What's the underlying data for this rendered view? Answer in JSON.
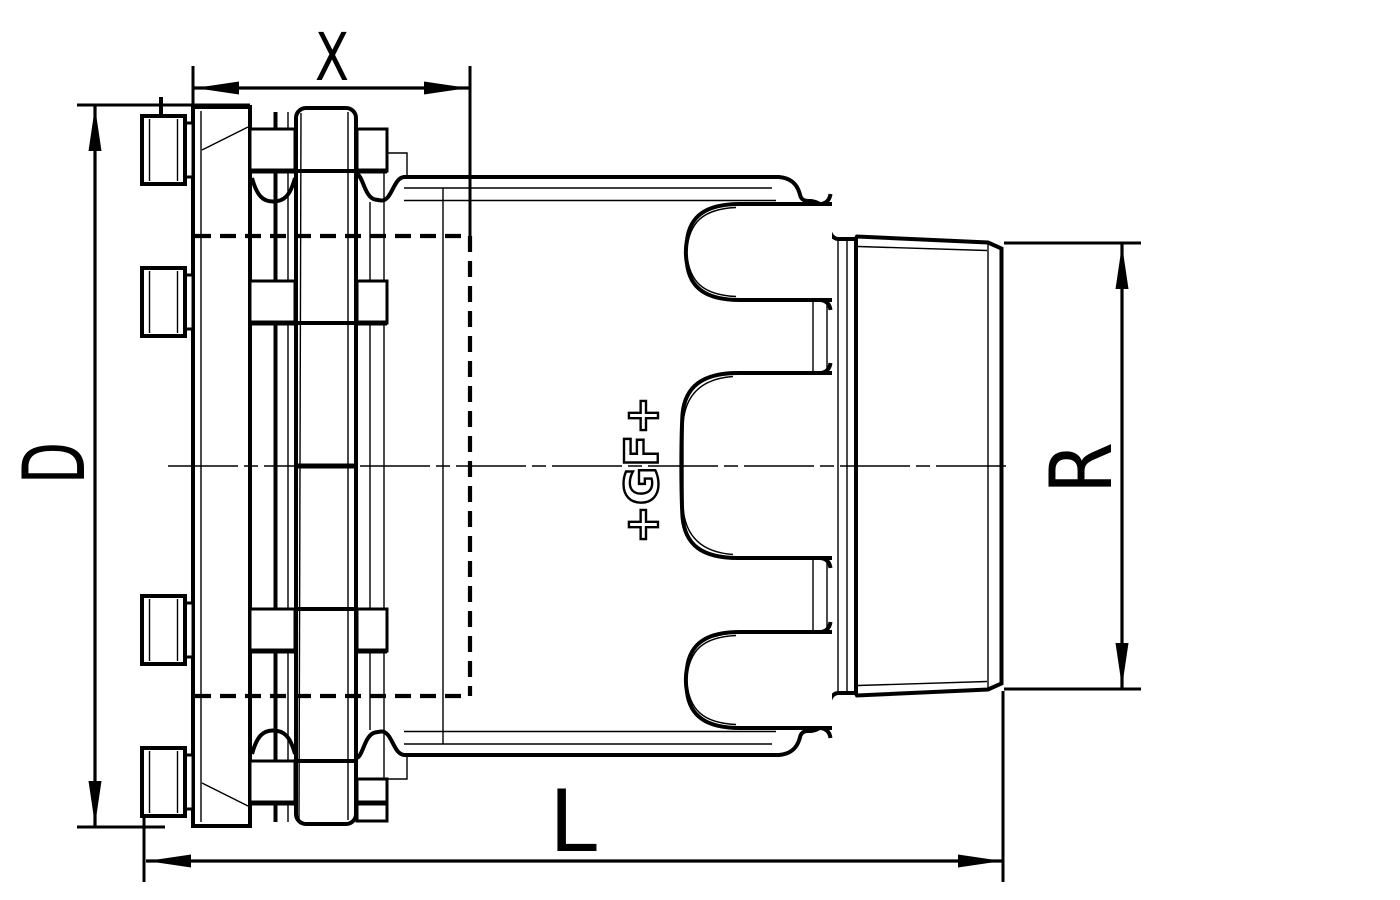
{
  "page": {
    "background_color": "#ffffff"
  },
  "drawing": {
    "kind": "technical-drawing",
    "line_color": "#000000",
    "fill_color": "#ffffff",
    "labels": {
      "x": "X",
      "d": "D",
      "r": "R",
      "l": "L"
    },
    "logo_text": "+GF+"
  }
}
